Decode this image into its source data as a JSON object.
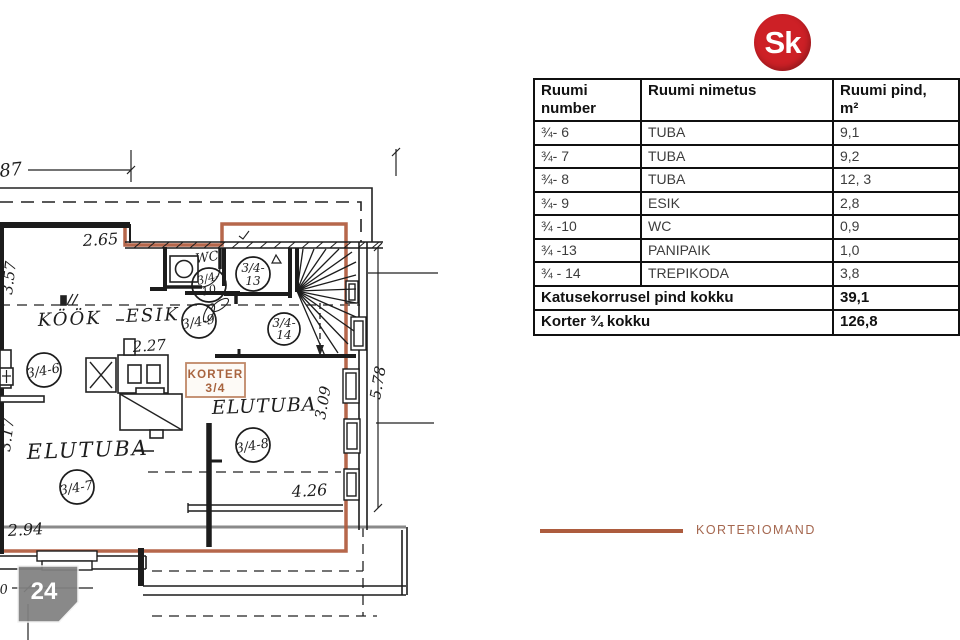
{
  "logo": {
    "text": "Sk"
  },
  "table": {
    "h1a": "Ruumi",
    "h1b": "number",
    "h2": "Ruumi nimetus",
    "h3a": "Ruumi pind,",
    "h3b": "m²",
    "rows": [
      {
        "num": "¾- 6",
        "name": "TUBA",
        "area": "9,1"
      },
      {
        "num": "¾- 7",
        "name": "TUBA",
        "area": "9,2"
      },
      {
        "num": "¾- 8",
        "name": "TUBA",
        "area": "12, 3"
      },
      {
        "num": "¾- 9",
        "name": "ESIK",
        "area": "2,8"
      },
      {
        "num": "¾ -10",
        "name": "WC",
        "area": "0,9"
      },
      {
        "num": "¾ -13",
        "name": "PANIPAIK",
        "area": "1,0"
      },
      {
        "num": "¾ - 14",
        "name": "TREPIKODA",
        "area": "3,8"
      }
    ],
    "total1_label": "Katusekorrusel pind kokku",
    "total1_value": "39,1",
    "total2_label": "Korter ¾ kokku",
    "total2_value": "126,8"
  },
  "legend": {
    "label": "KORTERIOMAND",
    "color": "#ad5c3e"
  },
  "badge": {
    "number": "24"
  },
  "plan": {
    "labels": {
      "kook": "KÖÖK",
      "esik": "ESIK",
      "elutuba_left": "ELUTUBA",
      "elutuba_right": "ELUTUBA",
      "wc": "WC"
    },
    "circles": {
      "c6": "3/4-6",
      "c7": "3/4-7",
      "c8": "3/4-8",
      "c9": "3/4-9",
      "c10_top": "3/4-",
      "c10_bot": "10",
      "c13_top": "3/4-",
      "c13_bot": "13",
      "c14_top": "3/4-",
      "c14_bot": "14"
    },
    "dims": {
      "top_left": "87",
      "d265": "2.65",
      "d357": "3.57",
      "d227": "2.27",
      "d317": "3.17",
      "d294": "2.94",
      "d426": "4.26",
      "d309": "3.09",
      "d578": "5.78",
      "bottom_left": "0"
    },
    "korter_box": {
      "line1": "KORTER",
      "line2": "3/4"
    }
  }
}
